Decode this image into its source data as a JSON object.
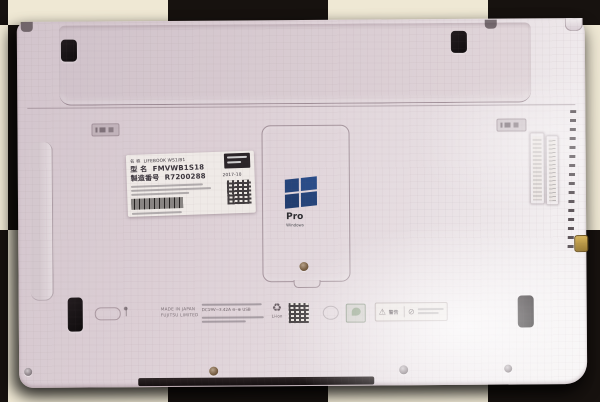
{
  "scene": {
    "description": "Photo: bottom of a white Fujitsu LIFEBOOK laptop on black-and-white checkered cloth",
    "cloth_light": "#efe8d4",
    "cloth_dark": "#17120f",
    "body_color": "#ddd2d7"
  },
  "info_label": {
    "name_label": "名 称",
    "name_value": "LIFEBOOK WS1/B1",
    "model_label": "型 名",
    "model_value": "FMVWB1S18",
    "serial_label": "製造番号",
    "serial_value": "R7200288",
    "date": "2017-10"
  },
  "windows_sticker": {
    "edition": "Pro",
    "brand": "Windows",
    "logo_color": "#26457b"
  },
  "regulatory": {
    "made_in": "MADE IN JAPAN",
    "manufacturer": "FUJITSU LIMITED",
    "rating": "DC19V⎓3.42A",
    "usb": "USB",
    "battery_type": "Li-ion",
    "warning": "警告"
  },
  "icons": {
    "recycle": "♻",
    "warning_triangle": "⚠",
    "prohibition": "⊘",
    "polarity": "⊖–⊕"
  }
}
